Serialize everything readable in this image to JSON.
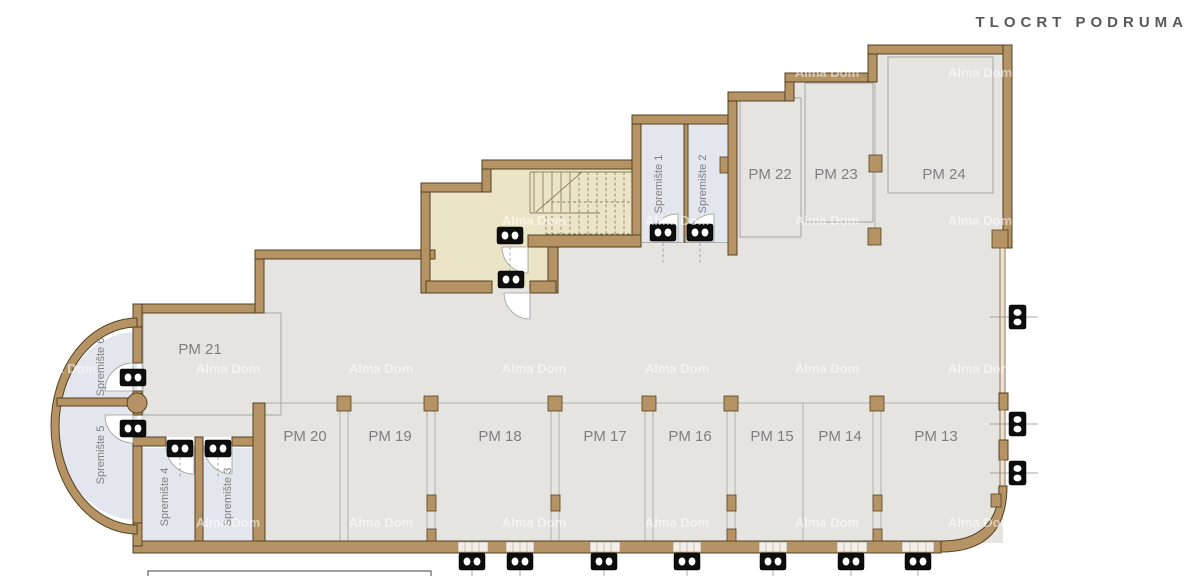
{
  "title": "TLOCRT PODRUMA",
  "watermark": "Alma Dom",
  "colors": {
    "background": "#ffffff",
    "wall_fill": "#b59364",
    "wall_outline": "#54401f",
    "floor_garage": "#e5e4e0",
    "floor_stairs": "#ece4c6",
    "floor_storage": "#e3e6ed",
    "room_outline": "#a3a3a0",
    "label_text": "#7f7f7f",
    "title_text": "#56585a",
    "symbol_black": "#0d0d0d"
  },
  "labels": {
    "pm13": "PM 13",
    "pm14": "PM 14",
    "pm15": "PM 15",
    "pm16": "PM 16",
    "pm17": "PM 17",
    "pm18": "PM 18",
    "pm19": "PM 19",
    "pm20": "PM 20",
    "pm21": "PM 21",
    "pm22": "PM 22",
    "pm23": "PM 23",
    "pm24": "PM 24",
    "spremiste1": "Spremište 1",
    "spremiste2": "Spremište 2",
    "spremiste3": "Spremište 3",
    "spremiste4": "Spremište 4",
    "spremiste5": "Spremište 5",
    "spremiste6": "Spremište 6"
  }
}
